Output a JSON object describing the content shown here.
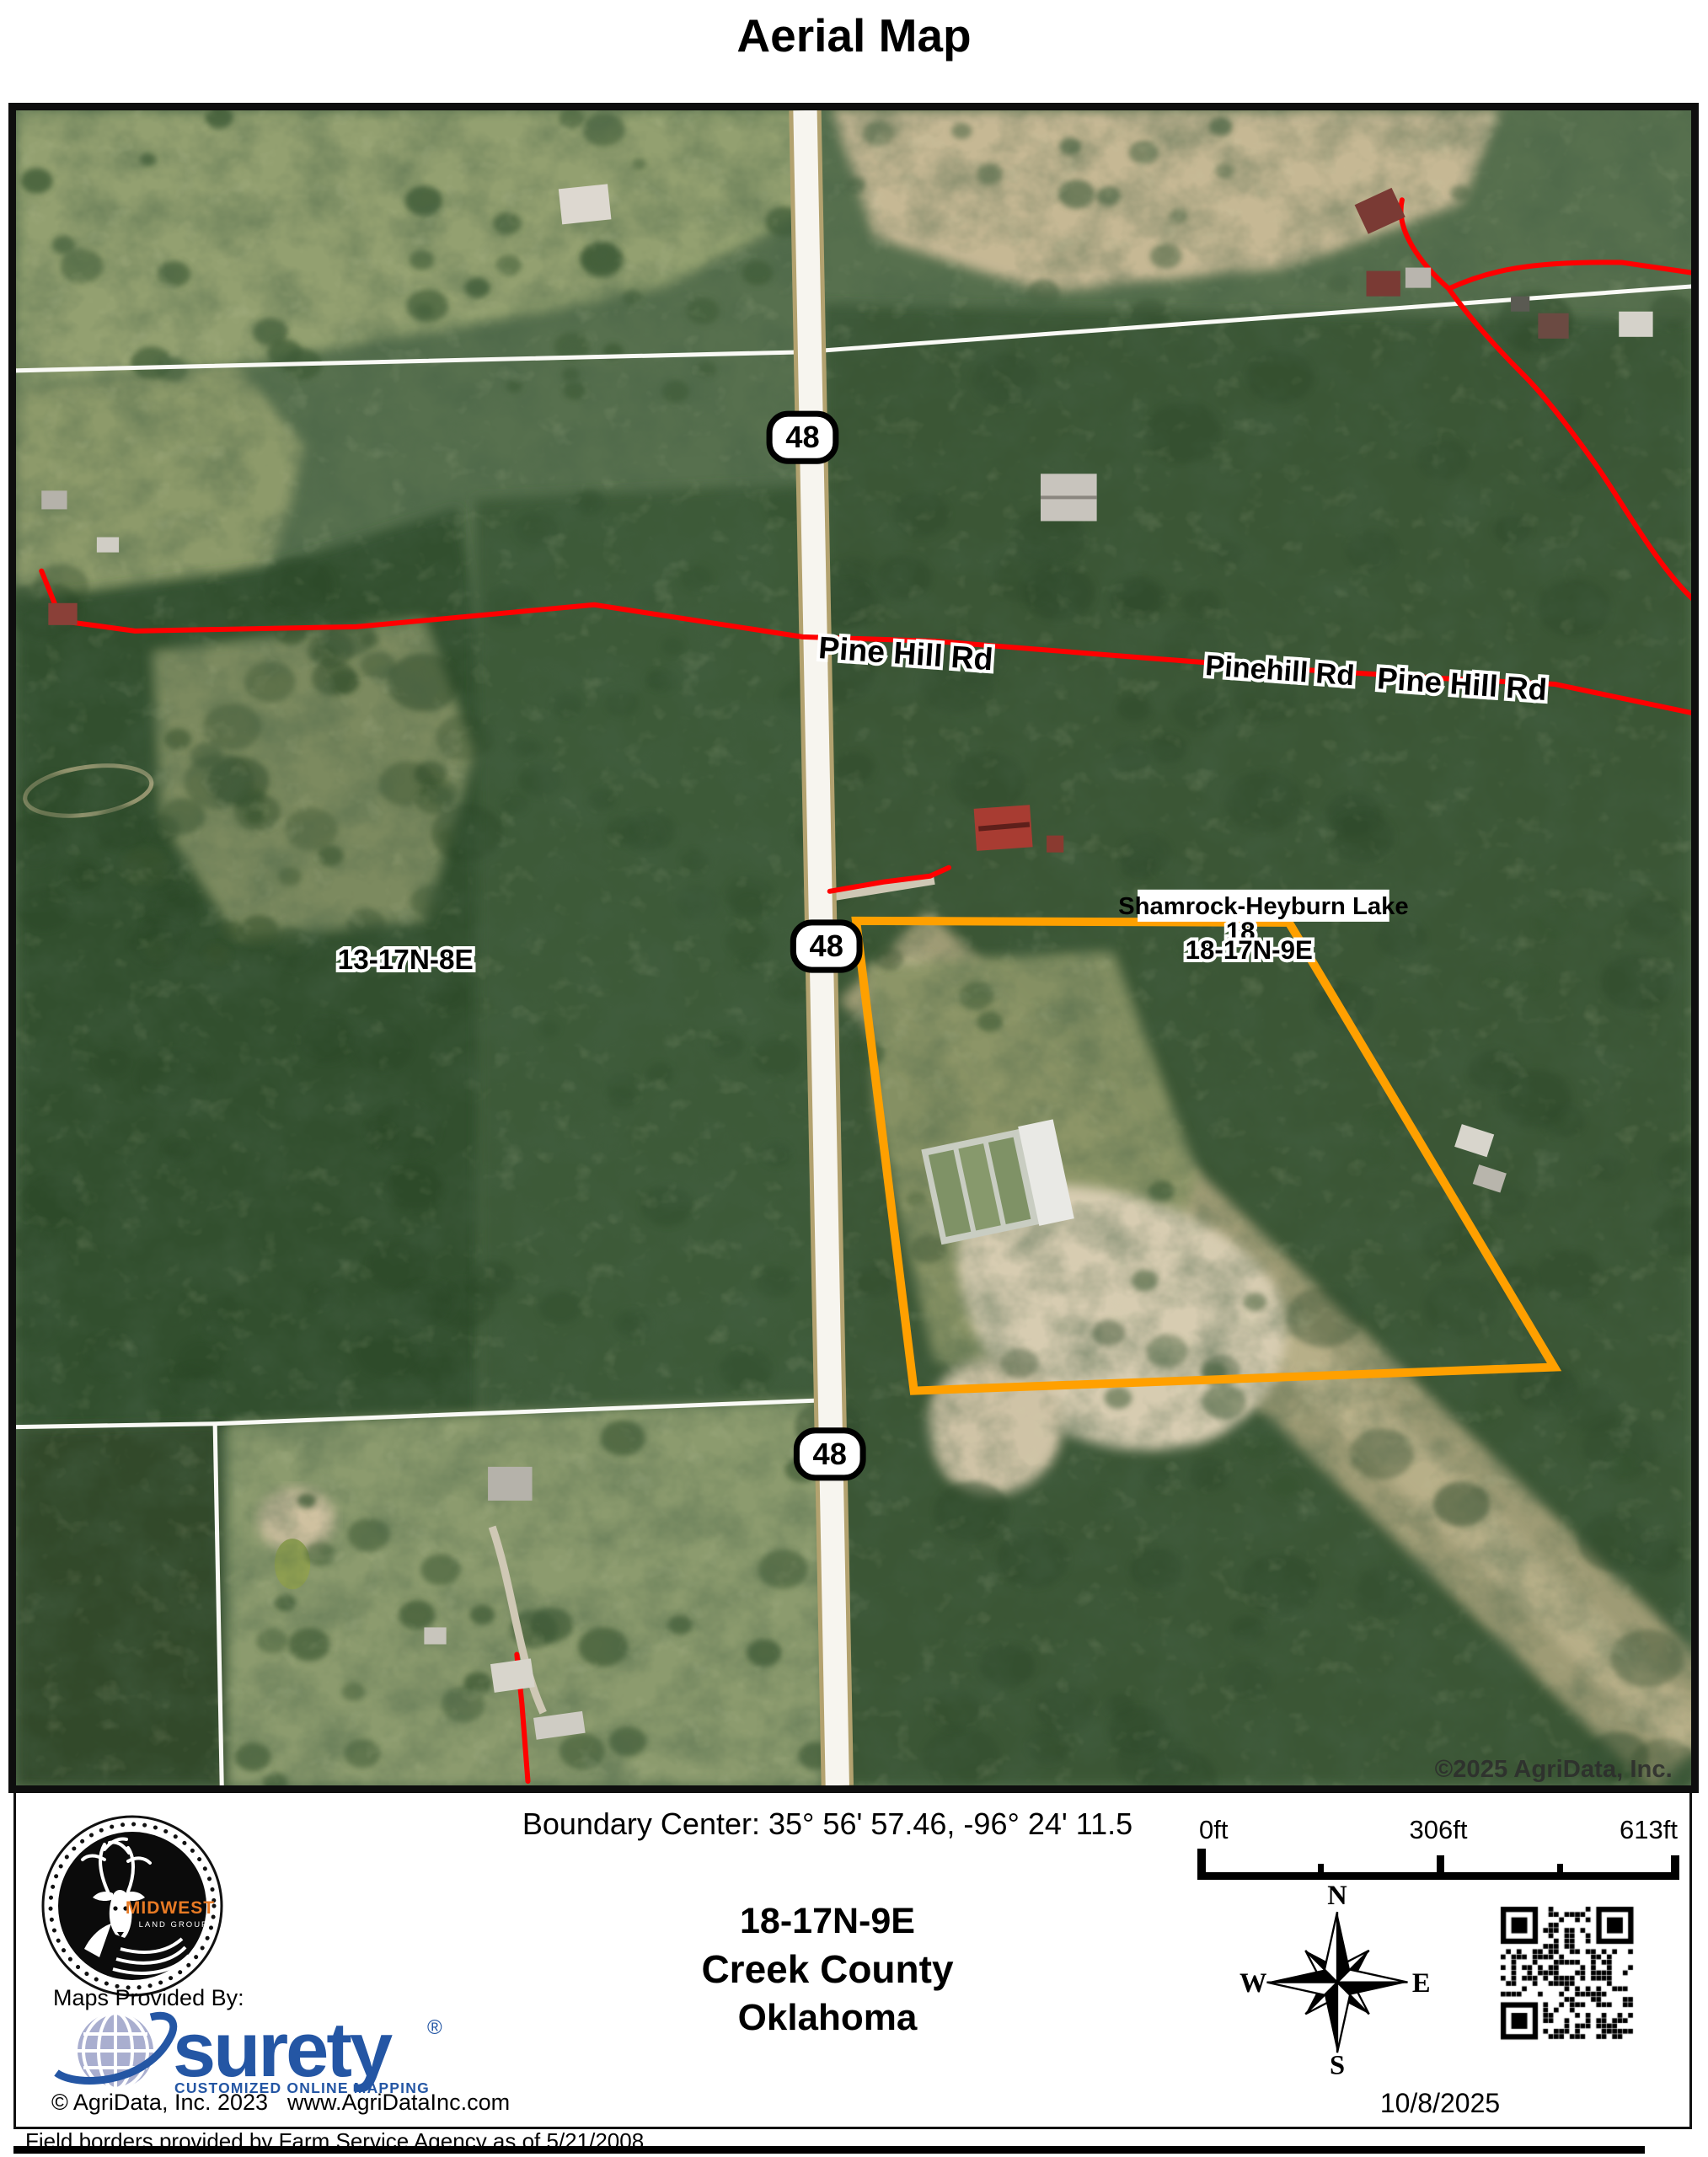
{
  "title": "Aerial Map",
  "map": {
    "shield": "48",
    "road_label_west": "Pine Hill Rd",
    "road_label_mid": "Pinehill Rd",
    "road_label_east": "Pine Hill Rd",
    "lake_label": "Shamrock-Heyburn Lake",
    "section_label_hidden": "18",
    "section_label": "18-17N-9E",
    "section_label_west": "13-17N-8E",
    "copyright": "©2025 AgriData, Inc.",
    "boundary_color": "#FFA000",
    "road_overlay_color": "#FF0000"
  },
  "footer": {
    "boundary_center": "Boundary Center: 35° 56' 57.46,  -96° 24' 11.5",
    "scale_labels": {
      "zero": "0ft",
      "mid": "306ft",
      "end": "613ft"
    },
    "section": "18-17N-9E",
    "county": "Creek County",
    "state": "Oklahoma",
    "compass": {
      "n": "N",
      "e": "E",
      "s": "S",
      "w": "W"
    },
    "date": "10/8/2025",
    "maps_provided_by": "Maps Provided By:",
    "brand": "surety",
    "brand_mark": "®",
    "brand_tagline": "CUSTOMIZED ONLINE MAPPING",
    "brand_color": "#2456a4",
    "brand_copyright": "© AgriData, Inc. 2023",
    "brand_website": "www.AgriDataInc.com",
    "logo_title": "MIDWEST",
    "logo_subtitle": "LAND GROUP",
    "logo_accent_color": "#e87a24",
    "disclaimer": "Field borders provided by Farm Service Agency as of 5/21/2008."
  }
}
